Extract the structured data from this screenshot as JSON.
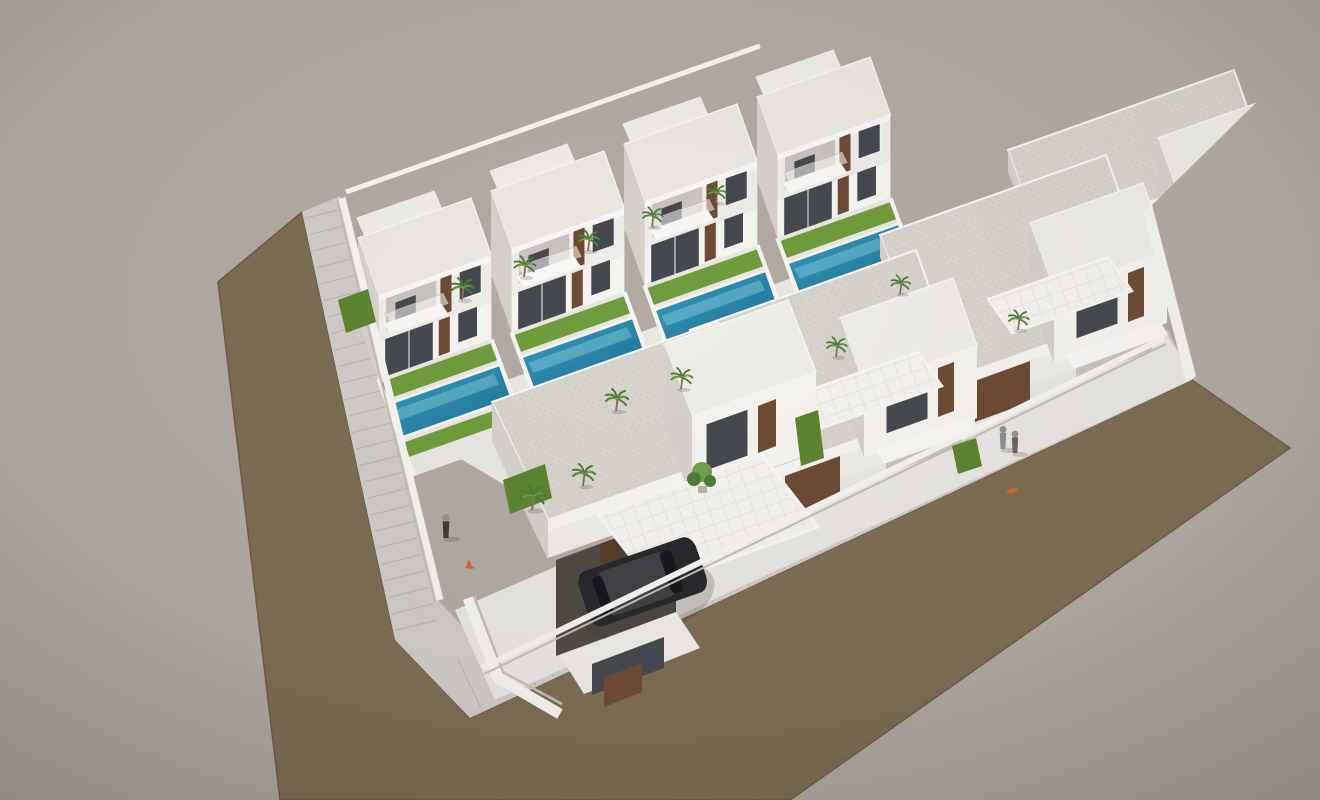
{
  "scene_description": "Aerial 3D architectural rendering of a new-build residential development: two rows of white modern two-storey villas with wood accents, private turquoise pools, green lawns and palm trees, wrapped by an L-shaped olive-brown road with a pale tiled sidewalk, on a plain warm-grey ground; a dark SUV is parked in a carport and a few tiny pedestrians stand on the sidewalks",
  "palette": {
    "bg": "#b3aaa4",
    "road": "#7c6d53",
    "road_edge": "#6c5e46",
    "sidewalk": "#cfccc9",
    "tile_line": "rgba(105,98,92,0.22)",
    "paving": "#e9e7e4",
    "wall_light": "#f6f4f1",
    "wall_mid": "#efede9",
    "wall_dark": "#d6d1cc",
    "wall_deep": "#c4beb8",
    "roof_flat": "#ebe8e4",
    "roof_edge": "#f8f7f5",
    "speckle_base": "#d8d4ce",
    "speckle_dot": "#c7c3bd",
    "tile_base": "#f5f3f0",
    "tile_grid": "#e2dfda",
    "wood": "#6e4a33",
    "wood_dark": "#573a2a",
    "window": "#45494f",
    "pool_light": "#3b9fc0",
    "pool_deep": "#1a6d92",
    "pool_glint": "rgba(150,215,230,0.4)",
    "lawn": "#6f9c3c",
    "lawn_dark": "#5d8530",
    "palm": "#4d7c39",
    "palm_light": "#6fa04a",
    "trunk": "#8a6b4e",
    "person_dark": "#3c3c3e",
    "person_gray": "#8f8f96",
    "person_mid": "#6b6560",
    "skin": "#9a8f83",
    "cone": "#d2622a",
    "dog": "#c96a33",
    "shadow": "rgba(62,52,44,0.20)",
    "shade": "#c9c4bf",
    "recess": "#4e4a44"
  },
  "scene": {
    "villas": {
      "count": 4,
      "scale": 0.85,
      "positions": [
        [
          358,
          238
        ],
        [
          491,
          191
        ],
        [
          624,
          144
        ],
        [
          757,
          97
        ]
      ]
    },
    "rowhouses": {
      "count": 3,
      "positions": [
        [
          690,
          330
        ],
        [
          880,
          235
        ],
        [
          1008,
          150
        ]
      ]
    },
    "palms": [
      [
        462,
        300,
        1
      ],
      [
        524,
        277,
        0.95
      ],
      [
        588,
        251,
        0.95
      ],
      [
        652,
        227,
        0.9
      ],
      [
        716,
        203,
        0.85
      ],
      [
        532,
        510,
        1.15
      ],
      [
        616,
        411,
        1
      ],
      [
        681,
        389,
        0.95
      ],
      [
        836,
        357,
        0.9
      ],
      [
        900,
        294,
        0.85
      ],
      [
        1018,
        330,
        0.9
      ],
      [
        583,
        486,
        1
      ]
    ],
    "hedges": [
      "503,480 545,464 552,498 510,514",
      "795,418 818,410 824,458 801,466",
      "952,446 976,438 982,466 958,474",
      "338,300 368,289 376,322 346,333"
    ],
    "people": [
      {
        "x": 446,
        "y": 538,
        "variant": "person_dark",
        "scale": 1.4
      },
      {
        "x": 1003,
        "y": 449,
        "variant": "person_gray",
        "scale": 1.35
      },
      {
        "x": 1015,
        "y": 453,
        "variant": "person_mid",
        "scale": 1.3
      }
    ],
    "props": {
      "cone": {
        "x": 469,
        "y": 567
      },
      "dog": {
        "x": 1011,
        "y": 491
      }
    },
    "car": {
      "transform": "translate(584,602) rotate(-19) scale(1.05,1.45)"
    },
    "sidewalk_tiles": {
      "left": {
        "x": 306,
        "y": 218,
        "sx": 3.58,
        "sy": 16.5,
        "dx": 40,
        "dy": -10,
        "count": 26
      },
      "bottom": {
        "x": 482,
        "y": 710,
        "sx": 17.8,
        "sy": -8.3,
        "dx": -24,
        "dy": -50,
        "count": 40
      }
    }
  }
}
